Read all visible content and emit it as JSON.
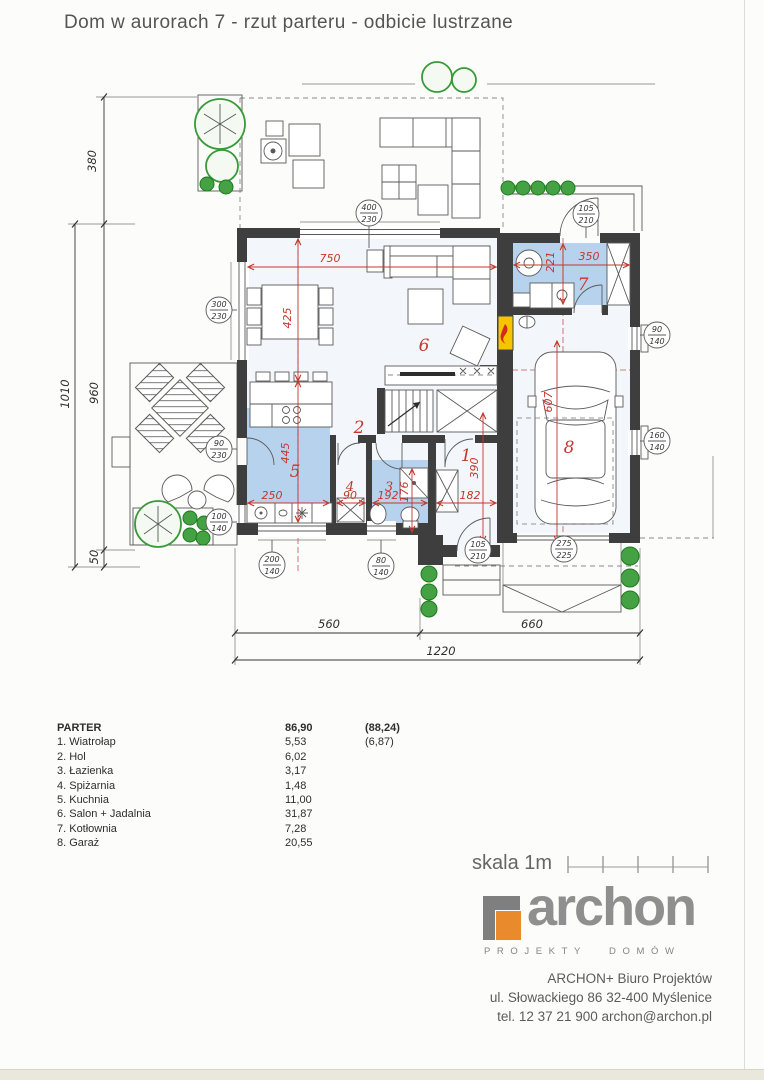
{
  "title": "Dom w aurorach 7 - rzut parteru - odbicie lustrzane",
  "plan": {
    "dims": {
      "left_top": "380",
      "left_outer": "1010",
      "left_inner": "960",
      "left_small": "50",
      "bottom_left": "560",
      "bottom_right": "660",
      "bottom_total": "1220"
    },
    "red_dims": {
      "salon_w": "750",
      "dining_h": "425",
      "kitchen_h": "445",
      "kitchen_w": "250",
      "pantry_w": "90",
      "bath_w": "192",
      "bath_h": "176",
      "hall_w": "182",
      "hall_h": "390",
      "garage_h": "607",
      "boiler_h": "221",
      "boiler_w": "350"
    },
    "rooms": {
      "r1": "1",
      "r2": "2",
      "r3": "3",
      "r4": "4",
      "r5": "5",
      "r6": "6",
      "r7": "7",
      "r8": "8"
    },
    "tags": [
      {
        "t": "400",
        "b": "230"
      },
      {
        "t": "105",
        "b": "210"
      },
      {
        "t": "90",
        "b": "140"
      },
      {
        "t": "160",
        "b": "140"
      },
      {
        "t": "275",
        "b": "225"
      },
      {
        "t": "105",
        "b": "210"
      },
      {
        "t": "80",
        "b": "140"
      },
      {
        "t": "200",
        "b": "140"
      },
      {
        "t": "100",
        "b": "140"
      },
      {
        "t": "90",
        "b": "230"
      },
      {
        "t": "300",
        "b": "230"
      }
    ]
  },
  "legend": {
    "header": {
      "name": "PARTER",
      "area": "86,90",
      "extra": "(88,24)"
    },
    "rows": [
      {
        "name": "1. Wiatrołap",
        "area": "5,53",
        "extra": "(6,87)"
      },
      {
        "name": "2. Hol",
        "area": "6,02",
        "extra": ""
      },
      {
        "name": "3. Łazienka",
        "area": "3,17",
        "extra": ""
      },
      {
        "name": "4. Spiżarnia",
        "area": "1,48",
        "extra": ""
      },
      {
        "name": "5. Kuchnia",
        "area": "11,00",
        "extra": ""
      },
      {
        "name": "6. Salon + Jadalnia",
        "area": "31,87",
        "extra": ""
      },
      {
        "name": "7. Kotłownia",
        "area": "7,28",
        "extra": ""
      },
      {
        "name": "8. Garaż",
        "area": "20,55",
        "extra": ""
      }
    ]
  },
  "scale": {
    "label": "skala 1m"
  },
  "branding": {
    "logo_text": "archon",
    "tagline": "PROJEKTY DOMÓW",
    "address_line1": "ARCHON+ Biuro Projektów",
    "address_line2": "ul. Słowackiego 86 32-400 Myślenice",
    "address_line3": "tel. 12 37 21 900 archon@archon.pl"
  },
  "colors": {
    "accent_orange": "#e98b2d",
    "room_fill": "#b7d2ec",
    "dim_red": "#c4372c",
    "wall": "#3e3e3e",
    "tree_green": "#44a244"
  }
}
